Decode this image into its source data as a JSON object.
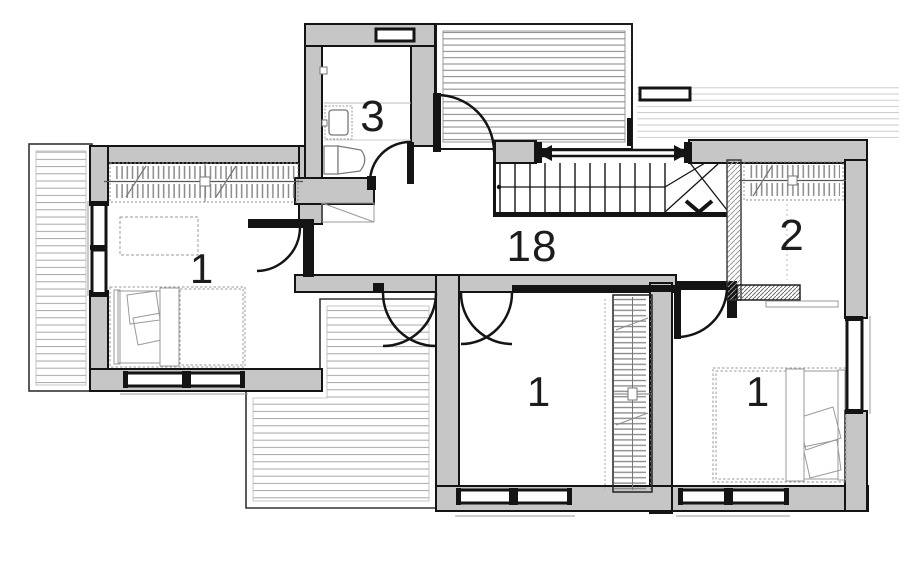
{
  "plan": {
    "drawing_type": "floor-plan",
    "rooms": [
      {
        "name": "bedroom-left",
        "label": "1"
      },
      {
        "name": "bathroom",
        "label": "3"
      },
      {
        "name": "hallway",
        "label": "18"
      },
      {
        "name": "closet-room",
        "label": "2"
      },
      {
        "name": "bedroom-middle",
        "label": "1"
      },
      {
        "name": "bedroom-right",
        "label": "1"
      }
    ],
    "icons": {
      "stair_direction": "chevron-down-arrow",
      "railing_ends": "arrowheads"
    },
    "colors": {
      "background": "#ffffff",
      "wall_fill": "#c6c6c6",
      "outline": "#141414",
      "roof_hatch": "#a6a6a6",
      "terrace_hatch": "#8e8e8e",
      "light_hatch": "#cccccc",
      "furniture_line": "#999999"
    }
  }
}
